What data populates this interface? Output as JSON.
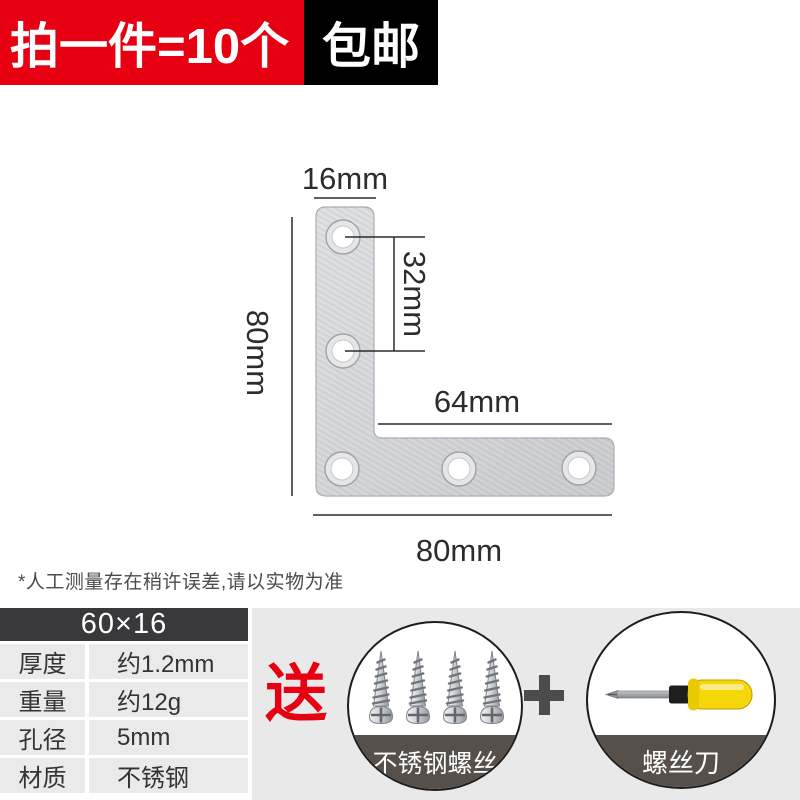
{
  "banner": {
    "promo_text": "拍一件=10个",
    "shipping_text": "包邮",
    "promo_bg": "#e60011",
    "shipping_bg": "#000000"
  },
  "diagram": {
    "labels": {
      "top_width": "16mm",
      "left_height": "80mm",
      "hole_spacing": "32mm",
      "inner_length": "64mm",
      "bottom_width": "80mm"
    },
    "hole_count": 5
  },
  "footnote": "*人工测量存在稍许误差,请以实物为准",
  "spec_table": {
    "header": "60×16",
    "rows": [
      {
        "label": "厚度",
        "value": "约1.2mm"
      },
      {
        "label": "重量",
        "value": "约12g"
      },
      {
        "label": "孔径",
        "value": "5mm"
      },
      {
        "label": "材质",
        "value": "不锈钢"
      }
    ]
  },
  "gift": {
    "label": "送",
    "plus_icon": "plus",
    "items": [
      {
        "name": "不锈钢螺丝"
      },
      {
        "name": "螺丝刀"
      }
    ]
  },
  "colors": {
    "accent_red": "#e60012",
    "table_header_bg": "#39393b",
    "table_row_bg": "#eaeaea",
    "panel_bg": "#e9e9e9",
    "band_bg": "#57504a"
  }
}
